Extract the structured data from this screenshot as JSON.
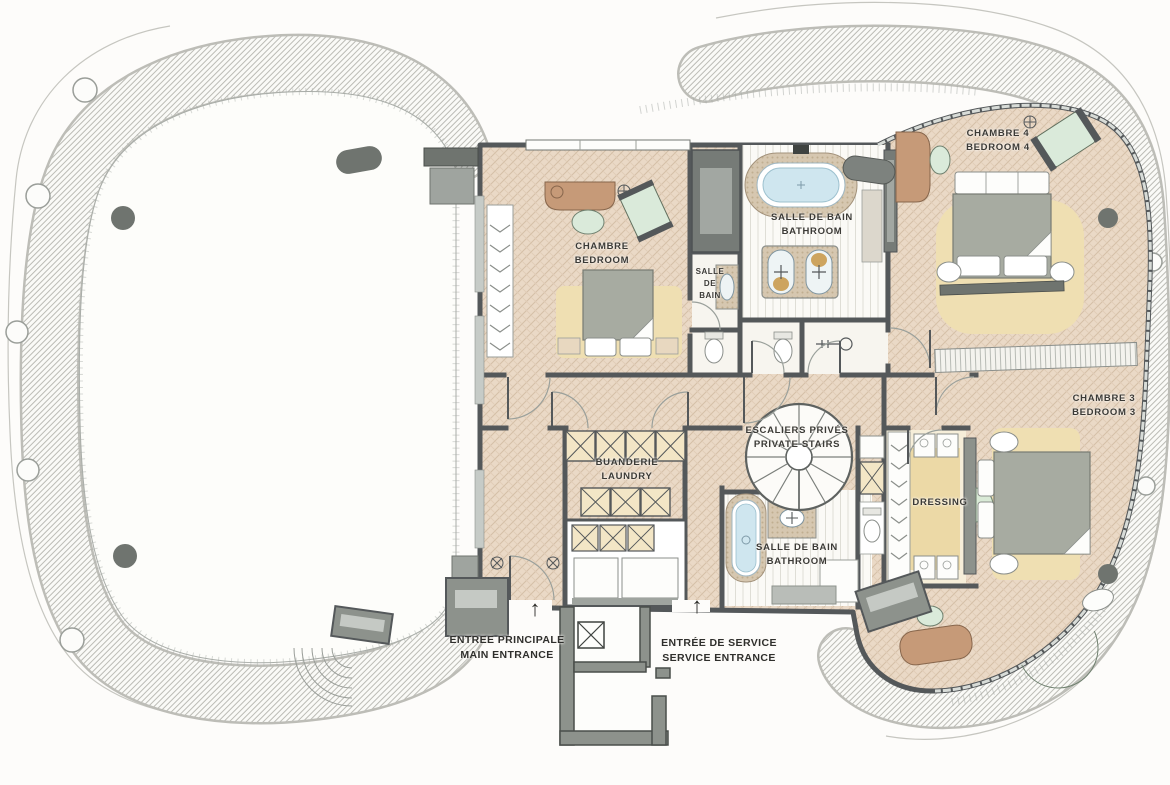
{
  "page": {
    "title": "Penthouse floor plan – bedrooms level"
  },
  "palette": {
    "wall": "#54585a",
    "wall_mid": "#8d928c",
    "floor_hatch": "#ead9c6",
    "hatch_line": "#d5bfa7",
    "rug": "#efdfb2",
    "dressing_rug": "#ecd9a6",
    "wood": "#c69a78",
    "greenery": "#d9ead6",
    "water": "#cfe6ef",
    "mosaic": "#d6c7b0",
    "terrace_stripe": "#b9b9b3",
    "text": "#3b3a36"
  },
  "labels": {
    "bedroom1": {
      "fr": "CHAMBRE",
      "en": "BEDROOM"
    },
    "bath_small": {
      "line1": "SALLE",
      "line2": "DE",
      "line3": "BAIN"
    },
    "bath_main": {
      "fr": "SALLE DE BAIN",
      "en": "BATHROOM"
    },
    "bedroom4": {
      "fr": "CHAMBRE 4",
      "en": "BEDROOM 4"
    },
    "bedroom3": {
      "fr": "CHAMBRE 3",
      "en": "BEDROOM 3"
    },
    "stairs": {
      "fr": "ESCALIERS PRIVÉS",
      "en": "PRIVATE STAIRS"
    },
    "laundry": {
      "fr": "BUANDERIE",
      "en": "LAUNDRY"
    },
    "dressing": {
      "fr": "DRESSING"
    },
    "bath_guest": {
      "fr": "SALLE DE BAIN",
      "en": "BATHROOM"
    },
    "entrance_main": {
      "fr": "ENTREE PRINCIPALE",
      "en": "MAIN ENTRANCE",
      "arrow": "↑"
    },
    "entrance_service": {
      "fr": "ENTRÉE DE SERVICE",
      "en": "SERVICE ENTRANCE",
      "arrow": "↑"
    }
  }
}
